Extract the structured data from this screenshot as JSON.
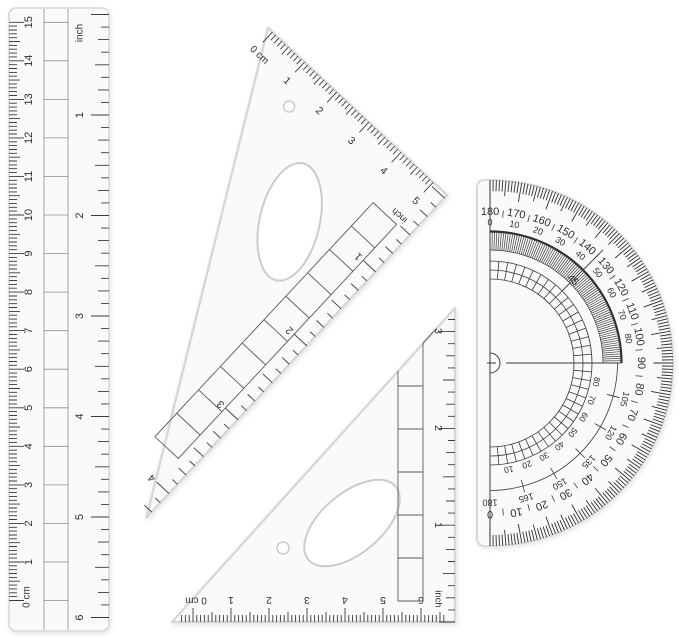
{
  "canvas": {
    "width": 679,
    "height": 637,
    "background": "#ffffff",
    "ink": "#3a3a3a",
    "plastic_fill": "#fafafc",
    "plastic_edge": "#d5d7dc"
  },
  "ruler": {
    "cm_zero_label": "0 cm",
    "cm_numbers": [
      1,
      2,
      3,
      4,
      5,
      6,
      7,
      8,
      9,
      10,
      11,
      12,
      13,
      14,
      15
    ],
    "inch_label": "inch",
    "inch_numbers": [
      1,
      2,
      3,
      4,
      5,
      6
    ]
  },
  "large_set_square": {
    "cm_zero_label": "0 cm",
    "cm_numbers": [
      1,
      2,
      3,
      4,
      5
    ],
    "inch_label": "inch",
    "inch_numbers": [
      1,
      2,
      3,
      4
    ]
  },
  "small_set_square": {
    "cm_zero_label": "0 cm",
    "cm_numbers": [
      1,
      2,
      3,
      4,
      5,
      6
    ],
    "inch_label": "inch",
    "inch_numbers": [
      1,
      2,
      3
    ]
  },
  "protractor": {
    "outer_scale": [
      180,
      170,
      160,
      150,
      140,
      130,
      120,
      110,
      100,
      90,
      80,
      70,
      60,
      50,
      40,
      30,
      20,
      10,
      0
    ],
    "upper_inner_scale": [
      0,
      10,
      20,
      30,
      40,
      50,
      60,
      70,
      80
    ],
    "lower_mid_scale": [
      105,
      120,
      135,
      150,
      165,
      180
    ],
    "lower_inner_scale": [
      10,
      20,
      30,
      40,
      50,
      60,
      70,
      80
    ],
    "angle_label": "45"
  }
}
